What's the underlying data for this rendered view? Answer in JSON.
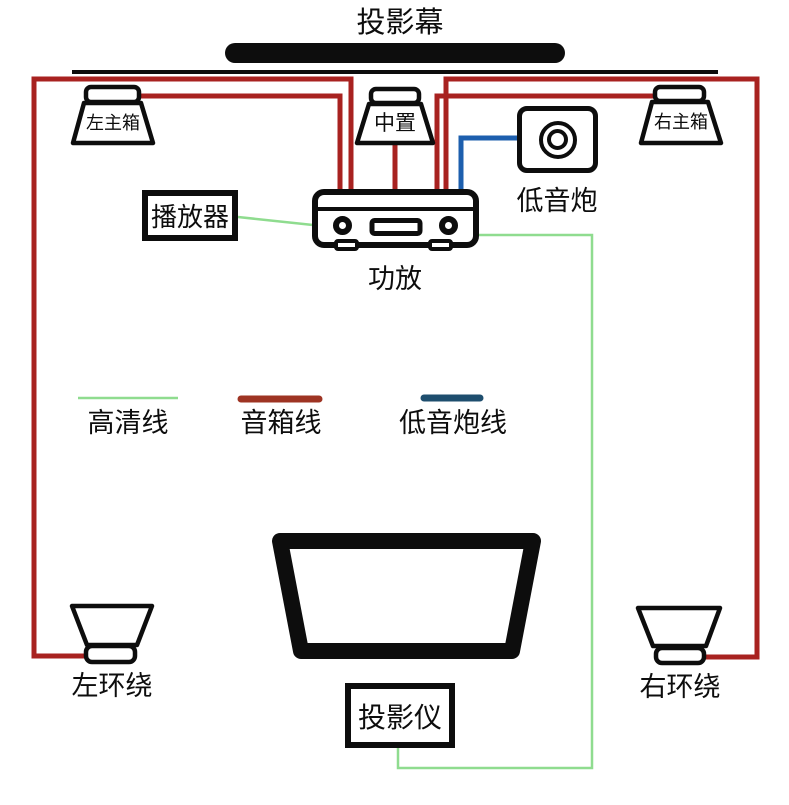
{
  "diagram": {
    "screen_label": "投影幕",
    "devices": {
      "left_main": {
        "label": "左主箱"
      },
      "center": {
        "label": "中置"
      },
      "right_main": {
        "label": "右主箱"
      },
      "subwoofer": {
        "label": "低音炮"
      },
      "player": {
        "label": "播放器"
      },
      "amplifier": {
        "label": "功放"
      },
      "left_surround": {
        "label": "左环绕"
      },
      "right_surround": {
        "label": "右环绕"
      },
      "projector": {
        "label": "投影仪"
      }
    },
    "legend": {
      "hd": {
        "label": "高清线",
        "color": "#8fdc8f"
      },
      "speaker": {
        "label": "音箱线",
        "color": "#9e3423"
      },
      "sub": {
        "label": "低音炮线",
        "color": "#1e4e6e"
      }
    },
    "colors": {
      "speaker_wire": "#a82220",
      "sub_wire": "#1d5fae",
      "hd_wire": "#8fdc8f",
      "outline": "#0d0d0d"
    }
  }
}
